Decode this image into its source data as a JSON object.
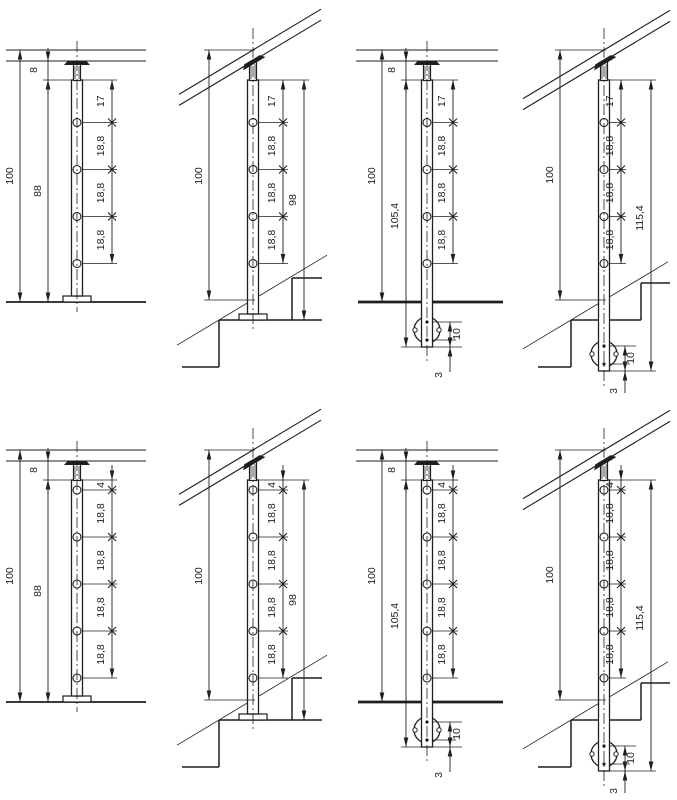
{
  "page": {
    "background": "#ffffff",
    "line_color": "#1f1f1f",
    "title": "railing-post-detail-drawings"
  },
  "drawings": [
    {
      "id": "post-floor-top-mount-4-holes",
      "variant": "level-top",
      "holes": 4,
      "labels": {
        "overall": "100",
        "post_height": "88",
        "rail_gap": "8",
        "first_offset": "17",
        "spacings": [
          "18,8",
          "18,8",
          "18,8"
        ]
      }
    },
    {
      "id": "post-stair-top-mount-4-holes",
      "variant": "stair-top",
      "holes": 4,
      "labels": {
        "overall": "100",
        "first_offset": "17",
        "spacings": [
          "18,8",
          "18,8",
          "18,8"
        ],
        "to_step": "98"
      }
    },
    {
      "id": "post-floor-side-mount-4-holes",
      "variant": "level-side",
      "holes": 4,
      "labels": {
        "overall": "100",
        "post_length": "105,4",
        "rail_gap": "8",
        "first_offset": "17",
        "spacings": [
          "18,8",
          "18,8",
          "18,8"
        ],
        "anchor_offset": "10",
        "plate_edge": "3"
      }
    },
    {
      "id": "post-stair-side-mount-4-holes",
      "variant": "stair-side",
      "holes": 4,
      "labels": {
        "overall": "100",
        "first_offset": "17",
        "spacings": [
          "18,8",
          "18,8",
          "18,8"
        ],
        "post_length": "115,4",
        "anchor_offset": "10",
        "plate_edge": "3"
      }
    },
    {
      "id": "post-floor-top-mount-5-holes",
      "variant": "level-top",
      "holes": 5,
      "labels": {
        "overall": "100",
        "post_height": "88",
        "rail_gap": "8",
        "first_offset": "4",
        "spacings": [
          "18,8",
          "18,8",
          "18,8",
          "18,8"
        ]
      }
    },
    {
      "id": "post-stair-top-mount-5-holes",
      "variant": "stair-top",
      "holes": 5,
      "labels": {
        "overall": "100",
        "first_offset": "4",
        "spacings": [
          "18,8",
          "18,8",
          "18,8",
          "18,8"
        ],
        "to_step": "98"
      }
    },
    {
      "id": "post-floor-side-mount-5-holes",
      "variant": "level-side",
      "holes": 5,
      "labels": {
        "overall": "100",
        "post_length": "105,4",
        "rail_gap": "8",
        "first_offset": "4",
        "spacings": [
          "18,8",
          "18,8",
          "18,8",
          "18,8"
        ],
        "anchor_offset": "10",
        "plate_edge": "3"
      }
    },
    {
      "id": "post-stair-side-mount-5-holes",
      "variant": "stair-side",
      "holes": 5,
      "labels": {
        "overall": "100",
        "first_offset": "4",
        "spacings": [
          "18,8",
          "18,8",
          "18,8",
          "18,8"
        ],
        "post_length": "115,4",
        "anchor_offset": "10",
        "plate_edge": "3"
      }
    }
  ]
}
